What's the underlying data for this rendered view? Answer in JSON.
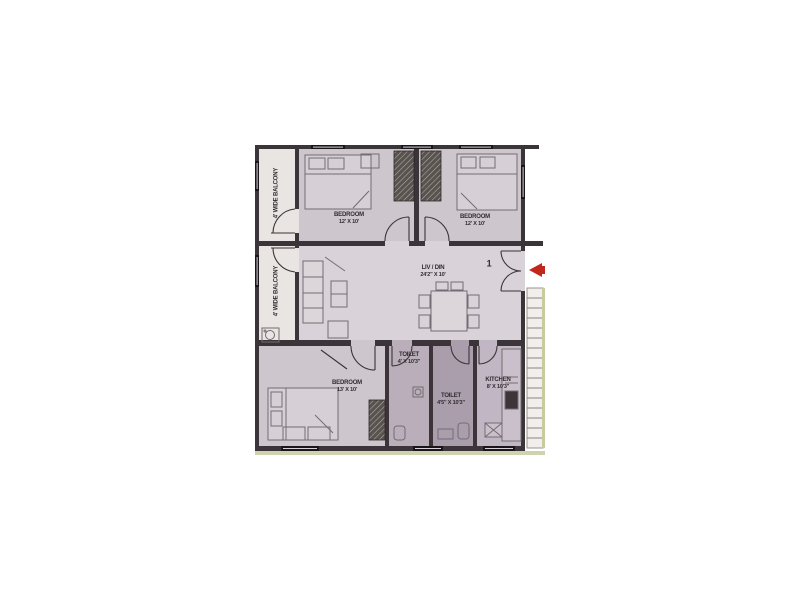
{
  "plan": {
    "title": "apartment-floor-plan",
    "unit_number": "1",
    "rooms": [
      {
        "id": "balcony-top",
        "name": "4' WIDE BALCONY",
        "dims": ""
      },
      {
        "id": "balcony-bottom",
        "name": "4' WIDE BALCONY",
        "dims": ""
      },
      {
        "id": "bedroom-1",
        "name": "BEDROOM",
        "dims": "12' X 10'"
      },
      {
        "id": "bedroom-2",
        "name": "BEDROOM",
        "dims": "12' X 10'"
      },
      {
        "id": "living-dining",
        "name": "LIV / DIN",
        "dims": "24'2\" X 10'"
      },
      {
        "id": "bedroom-3",
        "name": "BEDROOM",
        "dims": "13' X 10'"
      },
      {
        "id": "toilet-1",
        "name": "TOILET",
        "dims": "4' X 10'3\""
      },
      {
        "id": "toilet-2",
        "name": "TOILET",
        "dims": "4'5\" X 10'3\""
      },
      {
        "id": "kitchen",
        "name": "KITCHEN",
        "dims": "8' X 10'3\""
      }
    ],
    "colors": {
      "wall": "#3b3438",
      "bedroom_floor": "#cdc6cd",
      "living_floor": "#d9d2d8",
      "balcony_floor": "#e9e5e3",
      "toilet1_floor": "#b9aeba",
      "toilet2_floor": "#aa9ead",
      "kitchen_floor": "#c1b6c3",
      "entry_arrow": "#c1271b",
      "landscape_green": "#c6cc9f"
    }
  }
}
